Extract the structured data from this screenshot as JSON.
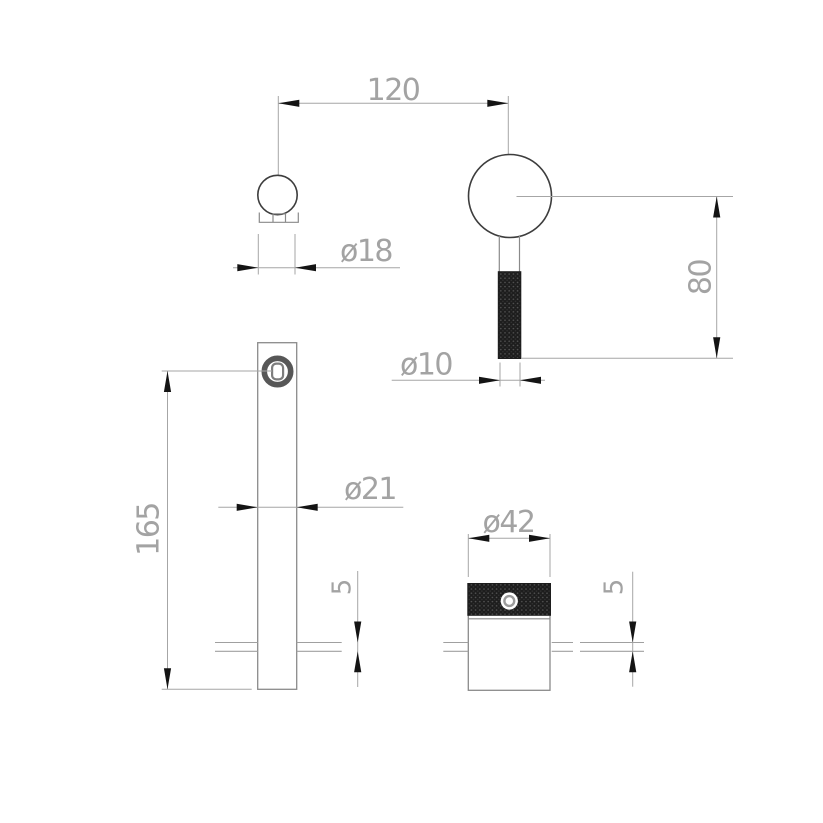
{
  "labels": {
    "handle_spacing": "120",
    "knob_diameter": "ø18",
    "handle_length": "80",
    "handle_stem_diameter": "ø10",
    "spout_diameter": "ø21",
    "spout_height": "165",
    "spout_plate_thickness": "5",
    "rosette_diameter": "ø42",
    "rosette_plate_thickness": "5"
  },
  "colors": {
    "background": "#ffffff",
    "dimension_line": "#a6a6a6",
    "dimension_text": "#a3a3a3",
    "arrowhead": "#141414",
    "part_outline_dark": "#3d3d3d",
    "part_outline_light": "#8a8a8a",
    "knurl_fill": "#1d1d1d"
  }
}
